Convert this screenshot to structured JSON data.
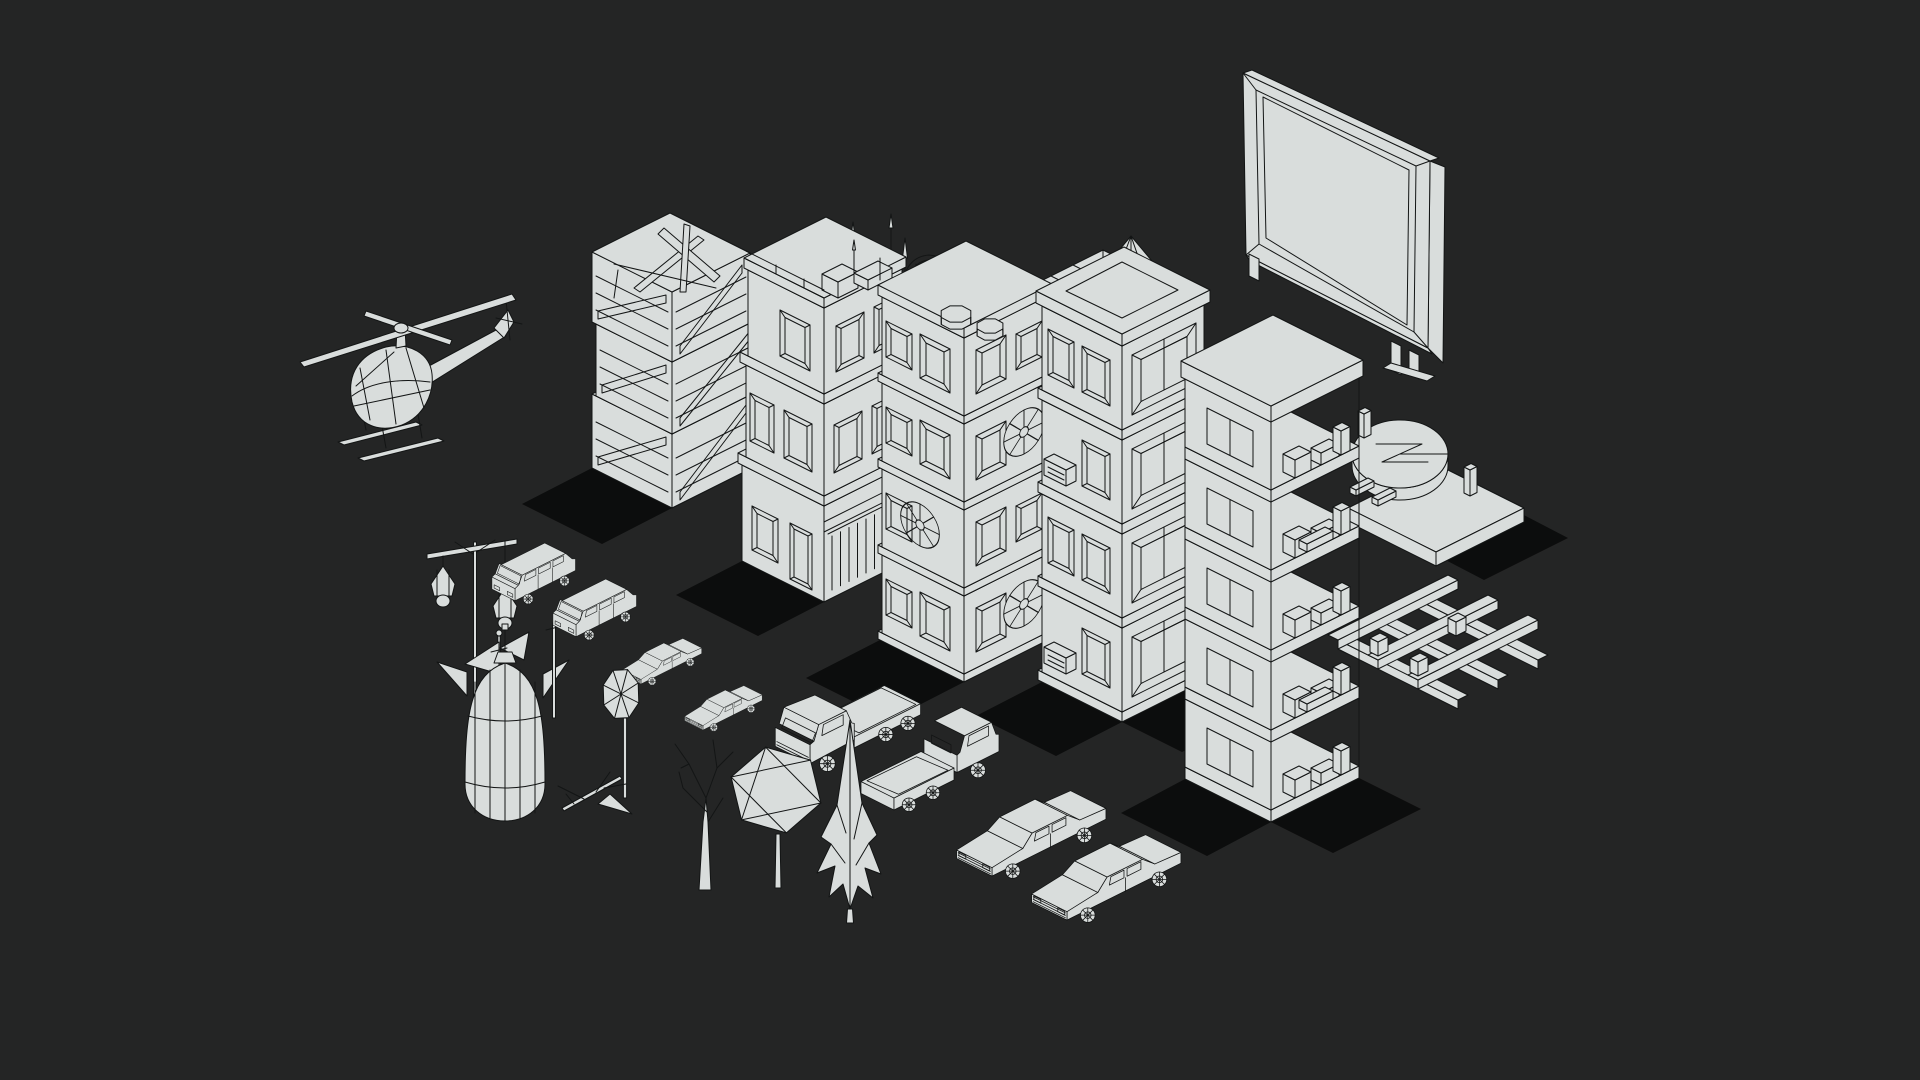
{
  "meta": {
    "description": "Isometric render of a low-poly wireframe city asset kit (buildings, vehicles, street props) on a dark charcoal background. No text or UI chrome is visible.",
    "background_color": "#242525",
    "model_fill_color": "#d9dddc",
    "model_line_color": "#131515",
    "shadow_color": "#0c0d0d",
    "object_count": 28
  },
  "scene": {
    "objects": [
      {
        "name": "billboard",
        "kind": "billboard",
        "label": "blank billboard panel",
        "x": 1243,
        "y": 73
      },
      {
        "name": "gate-fence",
        "kind": "gate",
        "label": "arched gate with spiked fence",
        "x": 845,
        "y": 250
      },
      {
        "name": "pavilion-building",
        "kind": "pavilion",
        "label": "flat-roof building with pyramid pavilion",
        "x": 1003,
        "y": 300
      },
      {
        "name": "helipad",
        "kind": "helipad",
        "label": "helipad platform with round pad",
        "x": 1348,
        "y": 508
      },
      {
        "name": "girder-platform",
        "kind": "girders",
        "label": "crossed steel girder platform",
        "x": 1338,
        "y": 640
      },
      {
        "name": "shanty-tower-1",
        "kind": "tower1",
        "label": "boarded-up shanty tower",
        "x": 672,
        "y": 508
      },
      {
        "name": "shanty-tower-2",
        "kind": "tower2",
        "label": "shanty tower with shuttered storefront",
        "x": 824,
        "y": 602
      },
      {
        "name": "fan-tower",
        "kind": "tower3",
        "label": "apartment tower with round vent fans",
        "x": 964,
        "y": 682
      },
      {
        "name": "balcony-tower",
        "kind": "tower4",
        "label": "apartment tower with balconies and AC units",
        "x": 1122,
        "y": 722
      },
      {
        "name": "cutaway-tower",
        "kind": "tower5",
        "label": "tower with exposed cutaway floors",
        "x": 1271,
        "y": 822
      },
      {
        "name": "helicopter",
        "kind": "heli",
        "label": "light helicopter",
        "x": 400,
        "y": 452
      },
      {
        "name": "street-lamp",
        "kind": "lamp",
        "label": "street lamp with hanging lanterns",
        "x": 475,
        "y": 700
      },
      {
        "name": "banner-pole",
        "kind": "banner",
        "label": "pole with pennant banners",
        "x": 499,
        "y": 768
      },
      {
        "name": "water-tank",
        "kind": "tank",
        "label": "rounded water tank",
        "x": 505,
        "y": 820
      },
      {
        "name": "utility-pole",
        "kind": "pole",
        "label": "utility pole",
        "x": 554,
        "y": 718
      },
      {
        "name": "van-1",
        "kind": "van",
        "label": "boxy van",
        "x": 515,
        "y": 604,
        "scale": 0.55
      },
      {
        "name": "van-2",
        "kind": "van",
        "label": "boxy SUV",
        "x": 576,
        "y": 640,
        "scale": 0.55
      },
      {
        "name": "car-1",
        "kind": "sedan",
        "label": "small sedan",
        "x": 641,
        "y": 686,
        "scale": 0.41
      },
      {
        "name": "car-2",
        "kind": "sedan",
        "label": "compact car",
        "x": 703,
        "y": 732,
        "scale": 0.4
      },
      {
        "name": "street-sign",
        "kind": "sign",
        "label": "oval street sign",
        "x": 625,
        "y": 798
      },
      {
        "name": "fallen-branch",
        "kind": "branch",
        "label": "fallen branch debris",
        "x": 592,
        "y": 802
      },
      {
        "name": "truck-1",
        "kind": "truckA",
        "label": "flatbed truck",
        "x": 810,
        "y": 770,
        "scale": 0.79
      },
      {
        "name": "truck-2",
        "kind": "truckB",
        "label": "flatbed truck (rear view)",
        "x": 894,
        "y": 810,
        "scale": 0.75
      },
      {
        "name": "dead-tree",
        "kind": "dtree",
        "label": "bare dead tree",
        "x": 705,
        "y": 890
      },
      {
        "name": "round-tree",
        "kind": "rtree",
        "label": "low-poly round tree",
        "x": 778,
        "y": 888
      },
      {
        "name": "pine-tree",
        "kind": "pine",
        "label": "tall pine tree",
        "x": 850,
        "y": 923
      },
      {
        "name": "sedan-1",
        "kind": "sedan",
        "label": "sedan",
        "x": 992,
        "y": 880,
        "scale": 0.77
      },
      {
        "name": "sedan-2",
        "kind": "sedan",
        "label": "sedan",
        "x": 1067,
        "y": 924,
        "scale": 0.77
      }
    ]
  }
}
